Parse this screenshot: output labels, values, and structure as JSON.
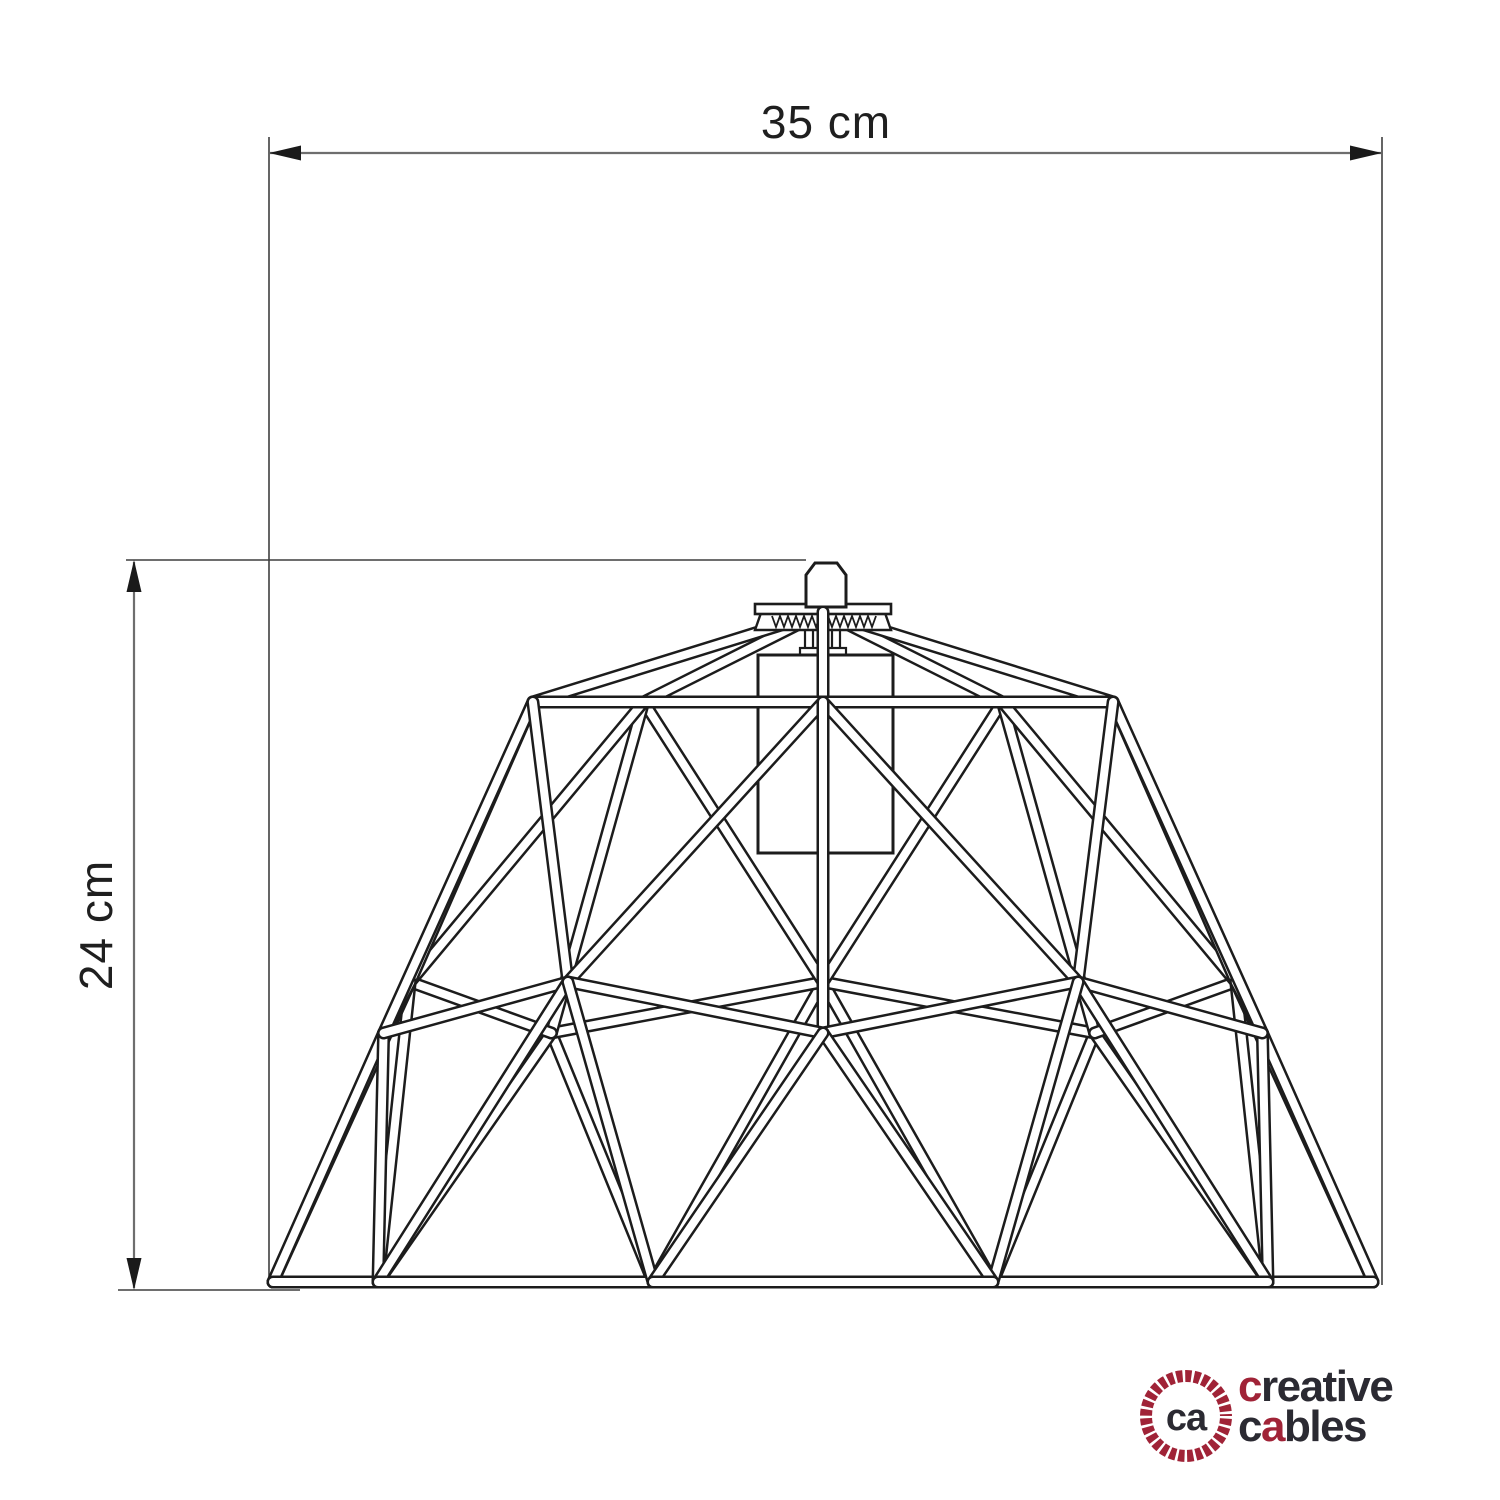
{
  "dimensions": {
    "width": {
      "label": "35 cm"
    },
    "height": {
      "label": "24 cm"
    }
  },
  "logo": {
    "monogram": "ca",
    "word1_initial": "c",
    "word1_rest": "reative",
    "word2_part1": "c",
    "word2_accent": "a",
    "word2_rest": "bles",
    "accent_color": "#a02337",
    "ink_color": "#2b2a32"
  },
  "drawing": {
    "stroke_color": "#1c1c1c",
    "dim_line_color": "#6e6e6e"
  }
}
